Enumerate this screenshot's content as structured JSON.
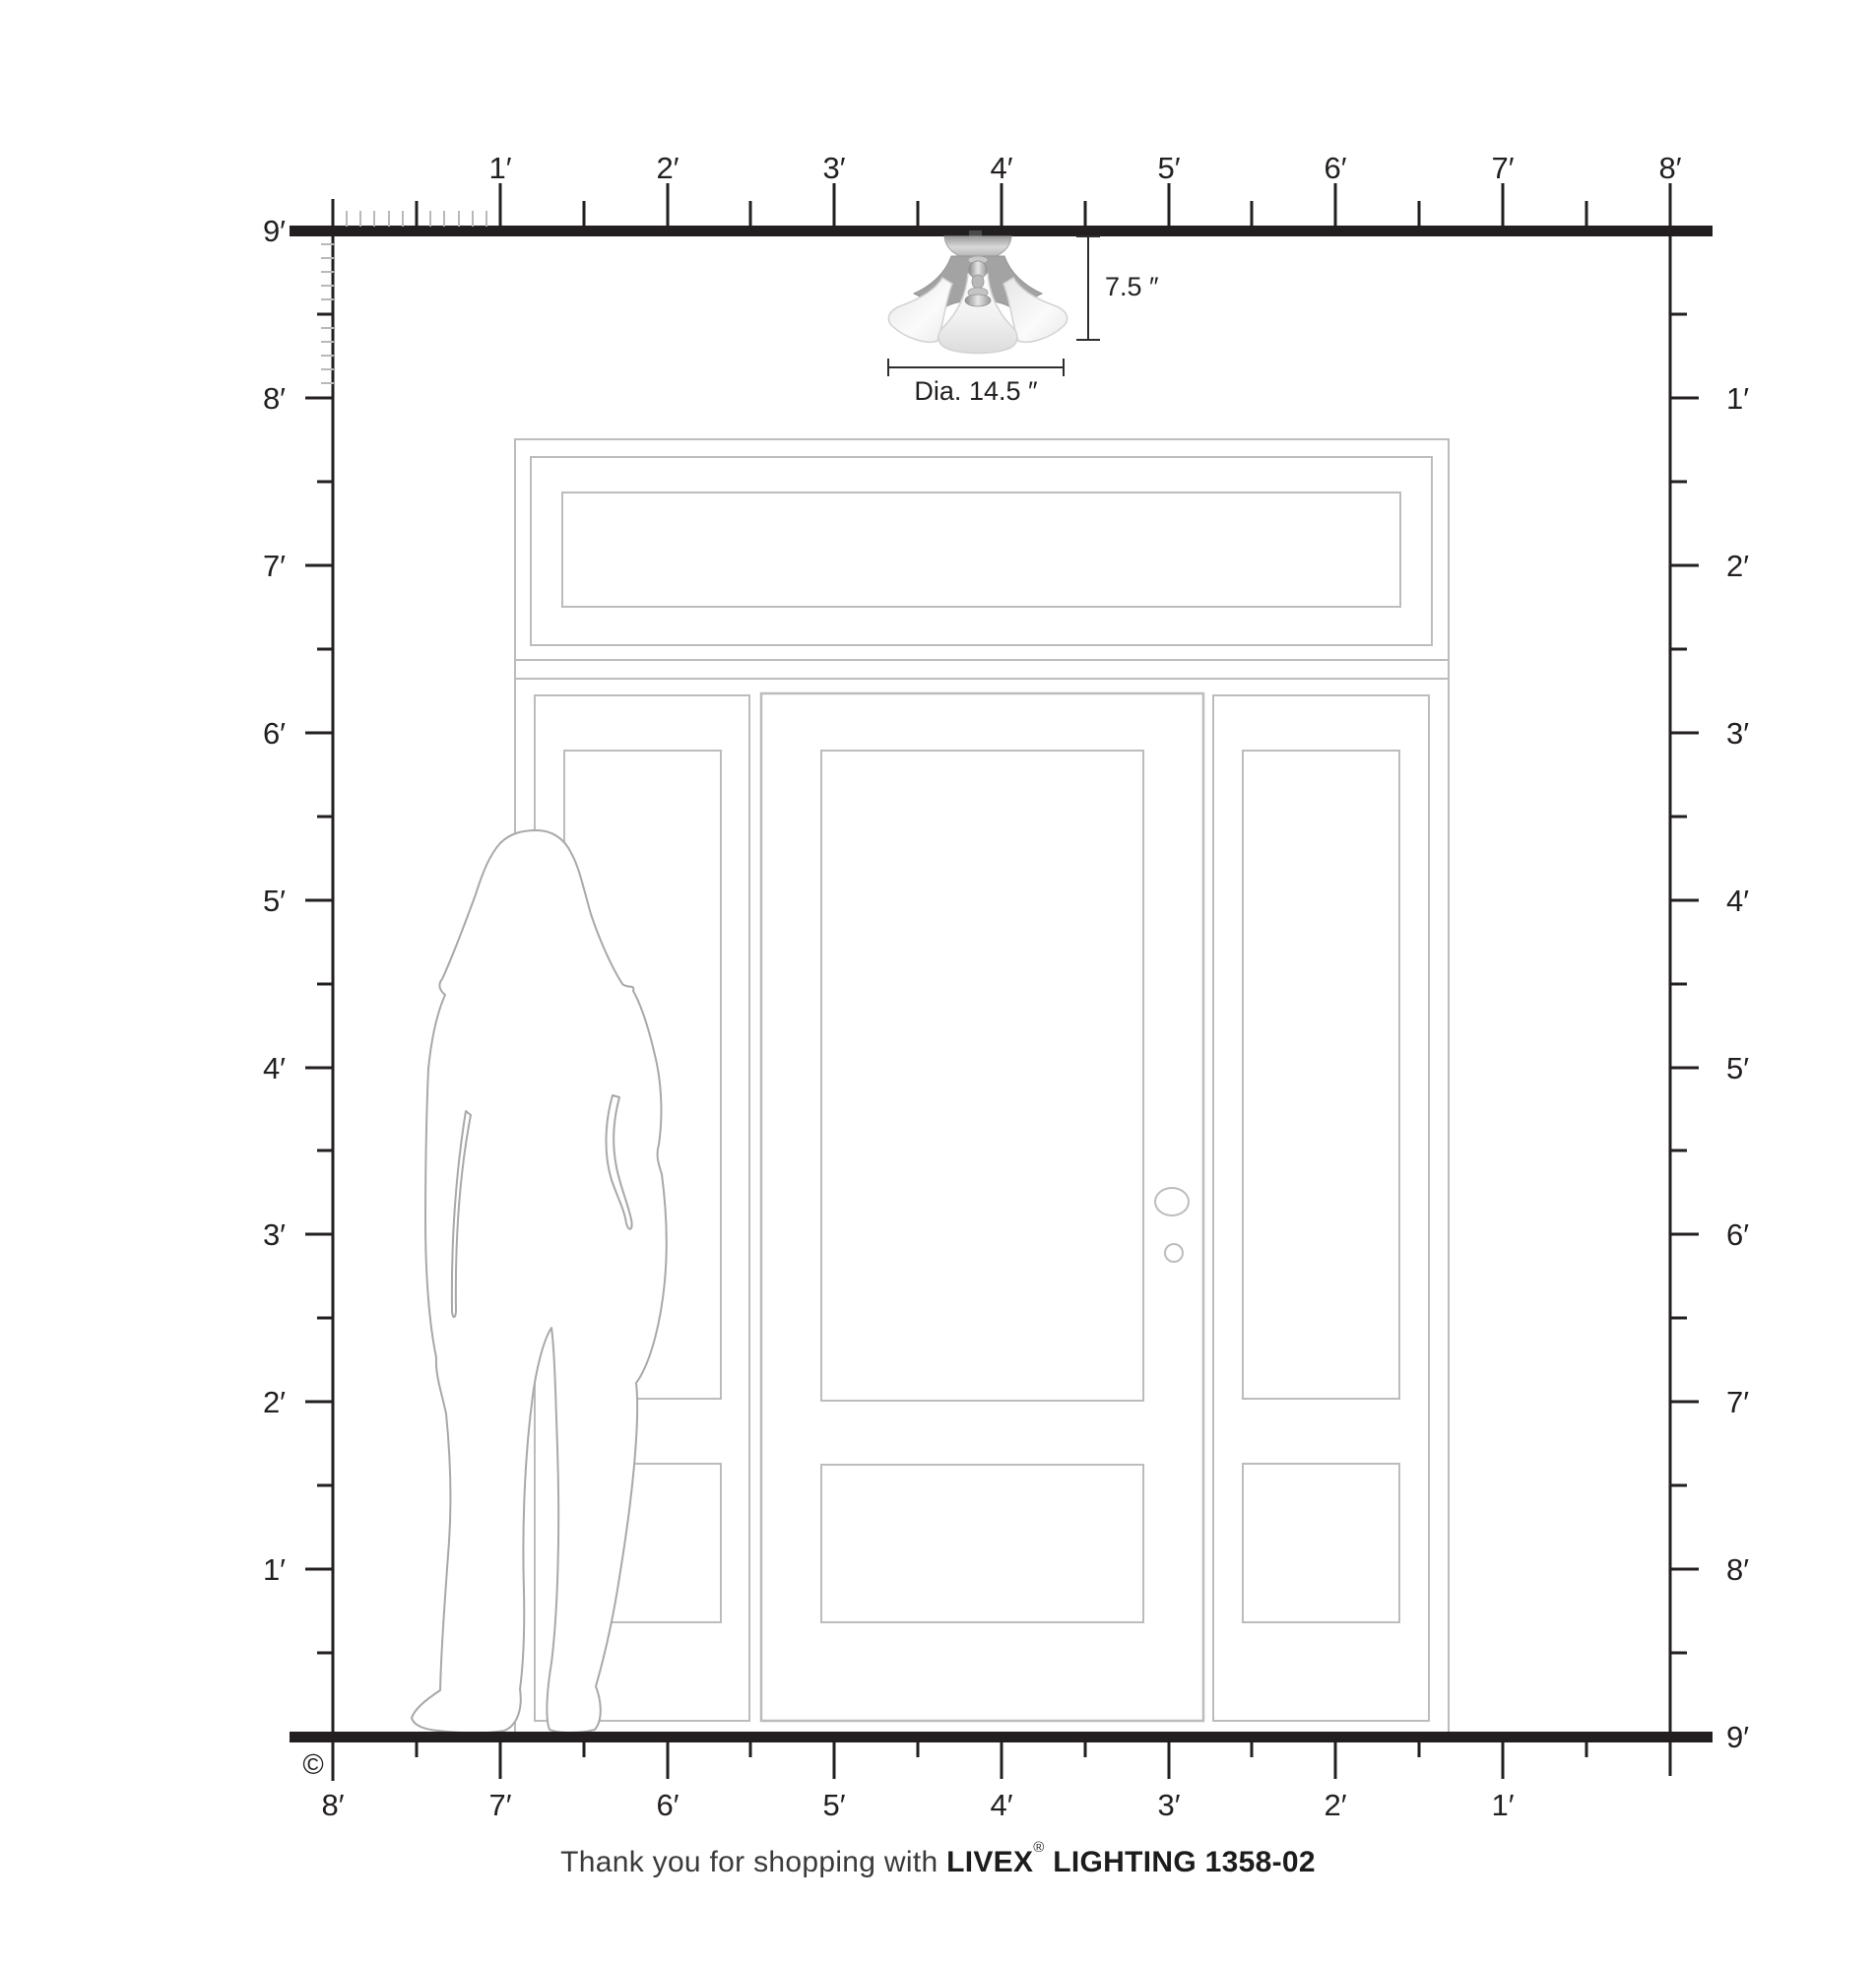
{
  "diagram_title": "Livex Lighting 1358-02 ceiling fixture scale diagram",
  "colors": {
    "ink": "#231f20",
    "door_line": "#bcbcbc",
    "figure_line": "#a8a8a8",
    "inch_tick": "#b9b9b9",
    "dim_line": "#2e2e2e",
    "metal_dark": "#8f8f8f",
    "metal_light": "#e2e2e2",
    "shade_light": "#fafafa",
    "shade_shadow": "#d8d8d8"
  },
  "rulers": {
    "unit": "feet",
    "top": {
      "labels": [
        "1′",
        "2′",
        "3′",
        "4′",
        "5′",
        "6′",
        "7′",
        "8′"
      ]
    },
    "bottom": {
      "labels": [
        "8′",
        "7′",
        "6′",
        "5′",
        "4′",
        "3′",
        "2′",
        "1′"
      ]
    },
    "left": {
      "labels": [
        "9′",
        "8′",
        "7′",
        "6′",
        "5′",
        "4′",
        "3′",
        "2′",
        "1′"
      ]
    },
    "right": {
      "labels": [
        "1′",
        "2′",
        "3′",
        "4′",
        "5′",
        "6′",
        "7′",
        "8′",
        "9′"
      ]
    }
  },
  "fixture": {
    "name": "3-light semi-flush ceiling fixture",
    "height_label": "7.5 ″",
    "diameter_label": "Dia. 14.5 ″"
  },
  "footer": {
    "copyright": "©",
    "thanks": "Thank you for shopping with ",
    "brand": "LIVEX",
    "registered": "®",
    "model": " LIGHTING 1358-02"
  }
}
